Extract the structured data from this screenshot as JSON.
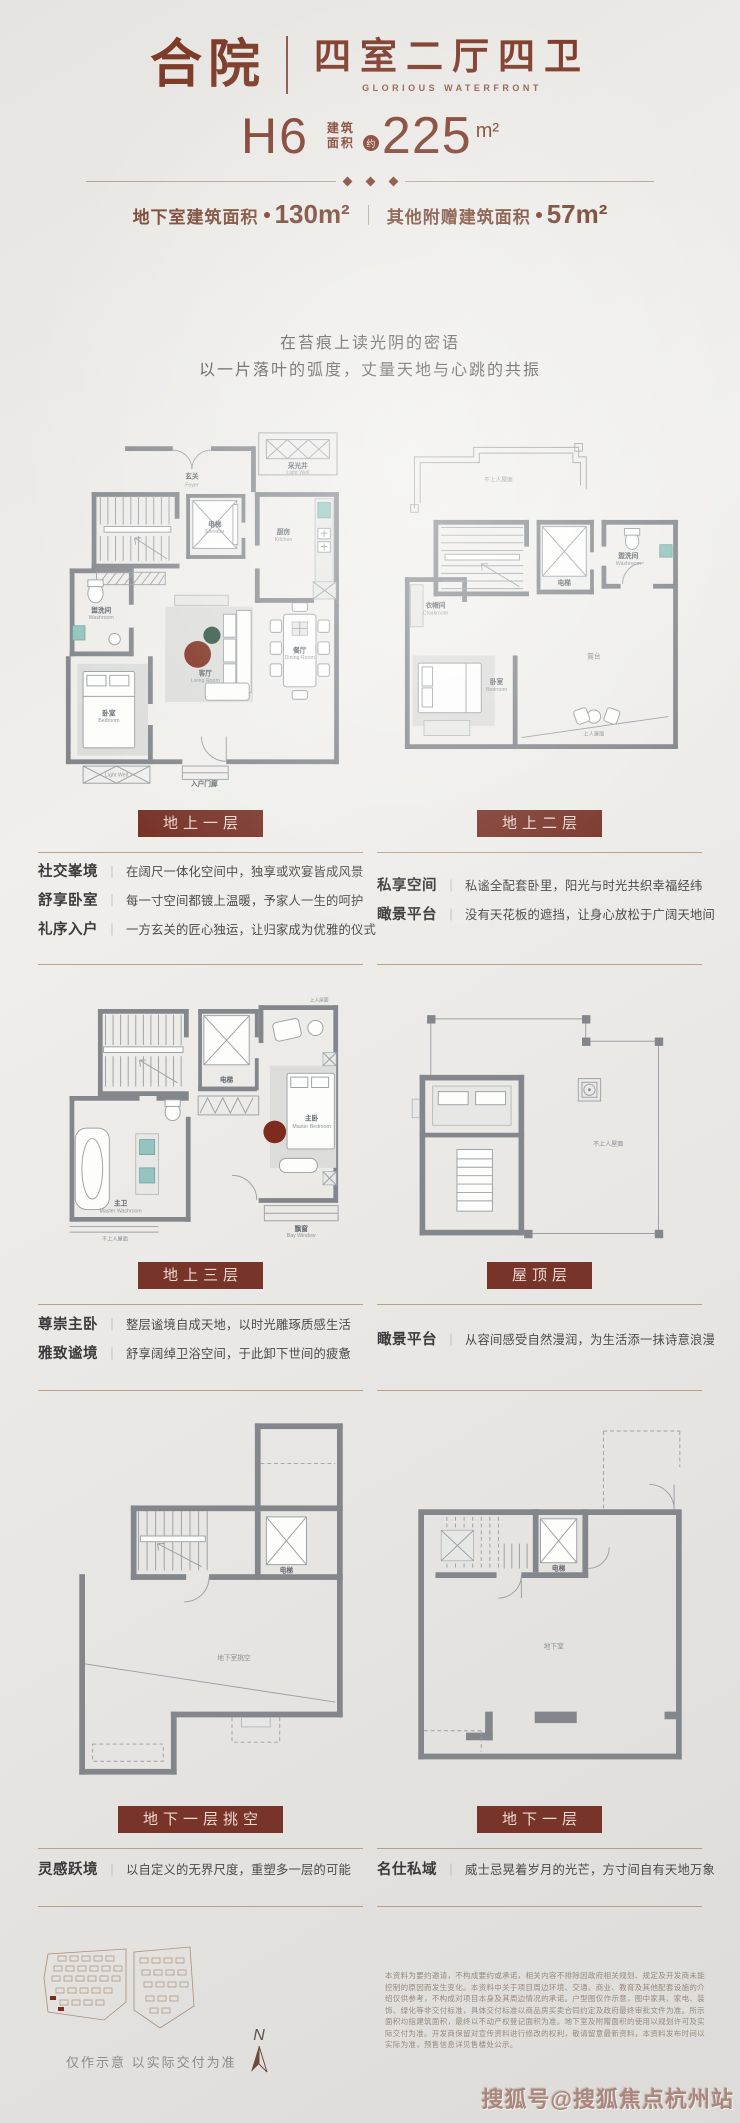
{
  "ui": {
    "sep": "｜"
  },
  "header": {
    "court": "合院",
    "layout": "四室二厅四卫",
    "en": "GLORIOUS WATERFRONT",
    "unit": "H6",
    "area_l1": "建筑",
    "area_l2": "面积",
    "approx": "约",
    "area": "225",
    "area_unit": "m²",
    "sub1_label": "地下室建筑面积",
    "sub1_value": "130m²",
    "sub2_label": "其他附赠建筑面积",
    "sub2_value": "57m²"
  },
  "poem": {
    "l1": "在苔痕上读光阴的密语",
    "l2": "以一片落叶的弧度，丈量天地与心跳的共振"
  },
  "floors": [
    {
      "label": "地上一层",
      "features": [
        {
          "term": "社交峯境",
          "desc": "在阔尺一体化空间中，独享或欢宴皆成风景"
        },
        {
          "term": "舒享卧室",
          "desc": "每一寸空间都镀上温暖，予家人一生的呵护"
        },
        {
          "term": "礼序入户",
          "desc": "一方玄关的匠心独运，让归家成为优雅的仪式"
        }
      ]
    },
    {
      "label": "地上二层",
      "features": [
        {
          "term": "私享空间",
          "desc": "私谧全配套卧里，阳光与时光共织幸福经纬"
        },
        {
          "term": "瞰景平台",
          "desc": "没有天花板的遮挡，让身心放松于广阔天地间"
        }
      ]
    },
    {
      "label": "地上三层",
      "features": [
        {
          "term": "尊崇主卧",
          "desc": "整层谧境自成天地，以时光雕琢质感生活"
        },
        {
          "term": "雅致谧境",
          "desc": "舒享阔绰卫浴空间，于此卸下世间的疲惫"
        }
      ]
    },
    {
      "label": "屋顶层",
      "features": [
        {
          "term": "瞰景平台",
          "desc": "从容间感受自然漫润，为生活添一抹诗意浪漫"
        }
      ]
    },
    {
      "label": "地下一层挑空",
      "features": [
        {
          "term": "灵感跃境",
          "desc": "以自定义的无界尺度，重塑多一层的可能"
        }
      ]
    },
    {
      "label": "地下一层",
      "features": [
        {
          "term": "名仕私域",
          "desc": "威士忌晃着岁月的光芒，方寸间自有天地万象"
        }
      ]
    }
  ],
  "rooms": {
    "p1": {
      "foyer": {
        "cn": "玄关",
        "en": "Foyer"
      },
      "lightwell": {
        "cn": "采光井",
        "en": "Light Well"
      },
      "lightwell2": {
        "cn": "采光井",
        "en": "Light Well"
      },
      "elevator": {
        "cn": "电梯",
        "en": "Elevator"
      },
      "kitchen": {
        "cn": "厨房",
        "en": "Kitchen"
      },
      "wash": {
        "cn": "盥洗间",
        "en": "Washroom"
      },
      "bedroom": {
        "cn": "卧室",
        "en": "Bedroom"
      },
      "living": {
        "cn": "客厅",
        "en": "Living Room"
      },
      "dining": {
        "cn": "餐厅",
        "en": "Dining Room"
      },
      "porch": {
        "cn": "入户门廊"
      }
    },
    "p2": {
      "roof": {
        "cn": "不上人屋面"
      },
      "elevator": {
        "cn": "电梯",
        "en": "Elevator"
      },
      "wash": {
        "cn": "盥洗间",
        "en": "Washroom"
      },
      "cloak": {
        "cn": "衣帽间",
        "en": "Cloakroom"
      },
      "bedroom": {
        "cn": "卧室",
        "en": "Bedroom"
      },
      "terrace": {
        "cn": "露台"
      },
      "terrace2": {
        "cn": "上人屋面"
      }
    },
    "p3": {
      "elevator": {
        "cn": "电梯",
        "en": "Elevator"
      },
      "master": {
        "cn": "主卧",
        "en": "Master Bedroom"
      },
      "bath": {
        "cn": "主卫",
        "en": "Master Washroom"
      },
      "bay": {
        "cn": "飘窗",
        "en": "Bay Window"
      },
      "roof": {
        "cn": "不上人屋面"
      },
      "terr": {
        "cn": "上人屋面"
      }
    },
    "p4": {
      "roof": {
        "cn": "不上人屋面"
      }
    },
    "p5": {
      "elevator": {
        "cn": "电梯"
      },
      "void": {
        "cn": "地下室挑空"
      }
    },
    "p6": {
      "elevator": {
        "cn": "电梯"
      },
      "base": {
        "cn": "地下室"
      }
    }
  },
  "footer": {
    "caption": "仅作示意 以实际交付为准",
    "compass": "N",
    "disclaimer": "本资料为要约邀请，不构成要约或承诺，相关内容不排除因政府相关规划、规定及开发商未能控制的原因而发生变化。本资料中关于项目周边环境、交通、商业、教育及其他配套设施的介绍仅供参考，不构成对项目本身及其周边情况的承诺。户型图仅作示意，图中家具、家电、装饰、绿化等非交付标准，具体交付标准以商品房买卖合同约定及政府最终审批文件为准。所示面积均指建筑面积，最终以不动产权登记面积为准。地下室及附赠面积的使用以规划许可及实际交付为准。开发商保留对宣传资料进行修改的权利，敬请留意最新资料，本资料发布时间以实际为准，预售信息详见售楼处公示。",
    "watermark": "搜狐号@搜狐焦点杭州站"
  }
}
